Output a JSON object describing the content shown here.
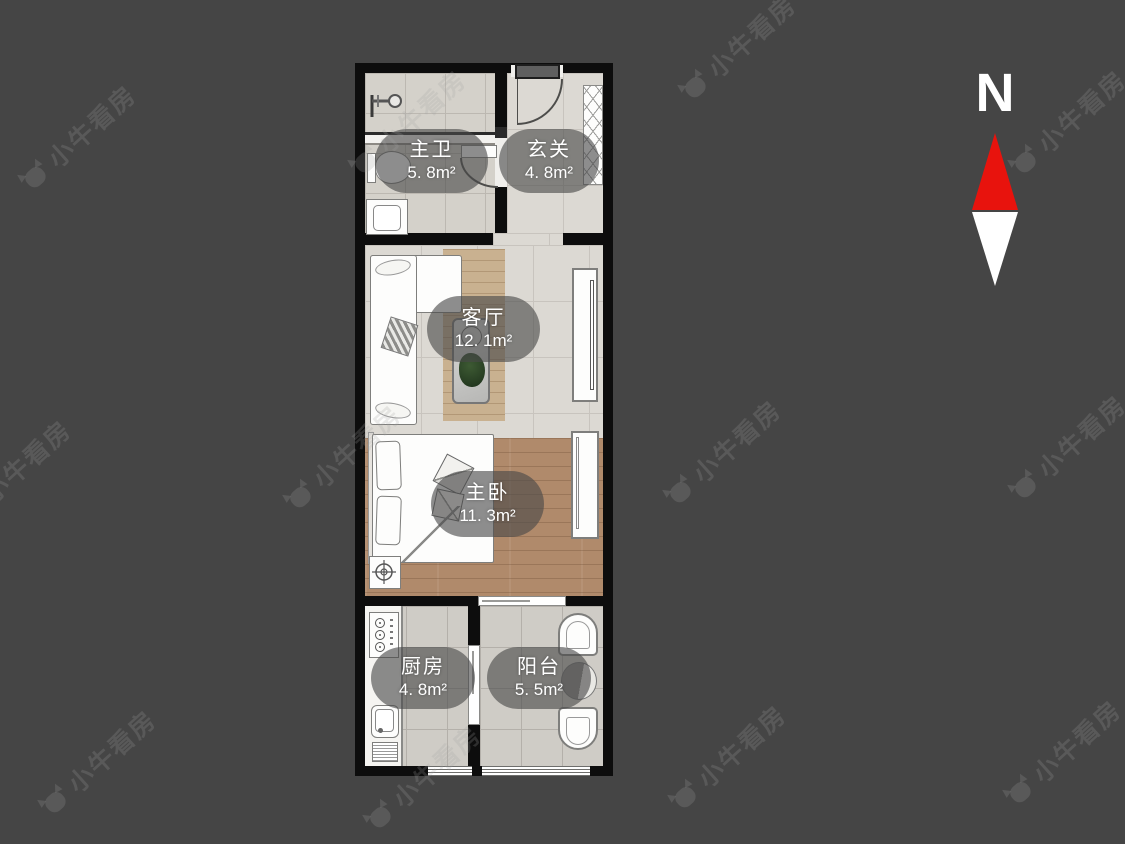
{
  "watermark": {
    "text": "小牛看房"
  },
  "compass": {
    "label": "N"
  },
  "floorplan": {
    "rooms": [
      {
        "id": "master-bath",
        "name": "主卫",
        "area": "5. 8m²"
      },
      {
        "id": "entry",
        "name": "玄关",
        "area": "4. 8m²"
      },
      {
        "id": "living-room",
        "name": "客厅",
        "area": "12. 1m²"
      },
      {
        "id": "master-bedroom",
        "name": "主卧",
        "area": "11. 3m²"
      },
      {
        "id": "kitchen",
        "name": "厨房",
        "area": "4. 8m²"
      },
      {
        "id": "balcony",
        "name": "阳台",
        "area": "5. 5m²"
      }
    ]
  },
  "colors": {
    "background": "#454545",
    "wall": "#0d0d0d",
    "compass_red": "#e8130d",
    "label_text": "#ffffff"
  }
}
